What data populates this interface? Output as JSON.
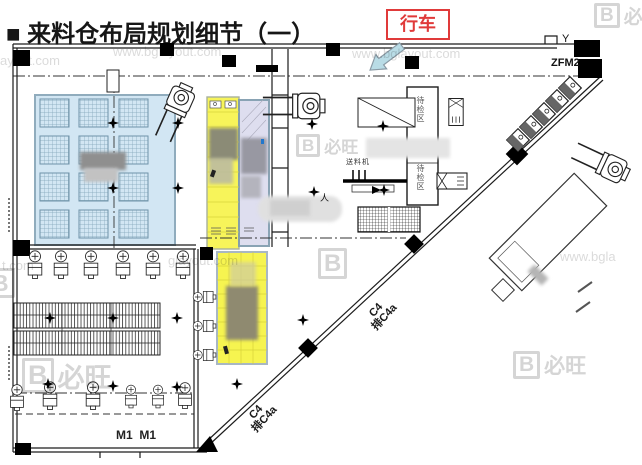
{
  "page": {
    "title": "■ 来料仓布局规划细节（一）",
    "crane_label": "行车"
  },
  "plan": {
    "door_label": "ZFM2",
    "wall_symbol": "Y",
    "m1_label": "M1  M1",
    "c4_upper": {
      "line1": "C4",
      "line2": "排C4a"
    },
    "c4_lower": {
      "line1": "C4",
      "line2": "排C4a"
    },
    "feeder_label": "送料机",
    "person_mark": "人",
    "room_label_a": "待检区",
    "room_label_b": "待检区"
  },
  "watermarks": {
    "url": "www.bglayout.com",
    "url_ayout": "ayout.com",
    "url_tcom": "t.com",
    "url_glayout": "glayout.com",
    "url_bgla": "www.bgla",
    "brand_initial": "B",
    "brand_name": "必旺"
  },
  "colors": {
    "pallet_zone_blue": "#cfe4f2",
    "zone_yellow": "#f6f33e",
    "zone_lavender": "#dcdcee",
    "crane_red": "#e03a3a",
    "arrow_blue": "#b9dce6"
  }
}
